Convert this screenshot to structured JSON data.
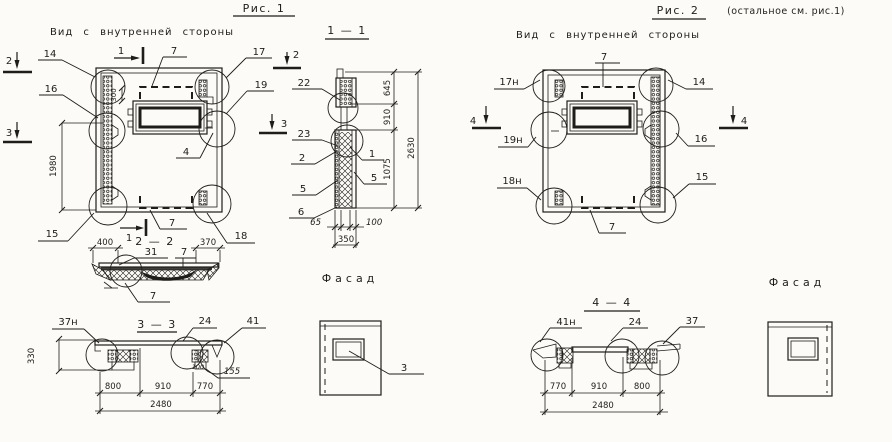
{
  "ink": "#1f1d1a",
  "paper": "#fcfbf7",
  "fig1": {
    "title": "Рис. 1",
    "subtitle": "Вид с внутренней стороны",
    "marker_1_top": "1",
    "marker_1_bottom": "1",
    "marker_2_left": "2",
    "marker_2_right": "2",
    "marker_3_left": "3",
    "marker_3_right": "3",
    "callout_14": "14",
    "callout_16": "16",
    "callout_15": "15",
    "callout_17": "17",
    "callout_19": "19",
    "callout_18": "18",
    "callout_7_top": "7",
    "callout_7_bottom": "7",
    "callout_4": "4",
    "dim_1980": "1980",
    "dim_300": "300"
  },
  "section11": {
    "title": "1 — 1",
    "callout_22": "22",
    "callout_23": "23",
    "callout_2": "2",
    "callout_5a": "5",
    "callout_5b": "5",
    "callout_6": "6",
    "callout_1": "1",
    "dim_645": "645",
    "dim_910": "910",
    "dim_1075": "1075",
    "dim_2630": "2630",
    "dim_65": "65",
    "dim_100": "100",
    "dim_350": "350"
  },
  "section22": {
    "title": "2 — 2",
    "callout_31": "31",
    "callout_7_top": "7",
    "callout_7_bottom": "7",
    "dim_400": "400",
    "dim_370": "370"
  },
  "section33": {
    "title": "3 — 3",
    "callout_37n": "37н",
    "callout_24": "24",
    "callout_41": "41",
    "dim_330": "330",
    "dim_100": "100",
    "dim_155": "155",
    "dim_800": "800",
    "dim_910": "910",
    "dim_770": "770",
    "dim_2480": "2480"
  },
  "facade1": {
    "title": "Фасад",
    "callout_3": "3"
  },
  "fig2": {
    "title": "Рис. 2",
    "note": "(остальное см. рис.1)",
    "subtitle": "Вид с внутренней стороны",
    "callout_17n": "17н",
    "callout_19n": "19н",
    "callout_18n": "18н",
    "callout_14": "14",
    "callout_16": "16",
    "callout_15": "15",
    "callout_7_top": "7",
    "callout_7_bottom": "7",
    "marker_4_left": "4",
    "marker_4_right": "4"
  },
  "section44": {
    "title": "4 — 4",
    "callout_41n": "41н",
    "callout_24": "24",
    "callout_37": "37",
    "dim_770": "770",
    "dim_910": "910",
    "dim_800": "800",
    "dim_2480": "2480"
  },
  "facade2": {
    "title": "Фасад"
  }
}
